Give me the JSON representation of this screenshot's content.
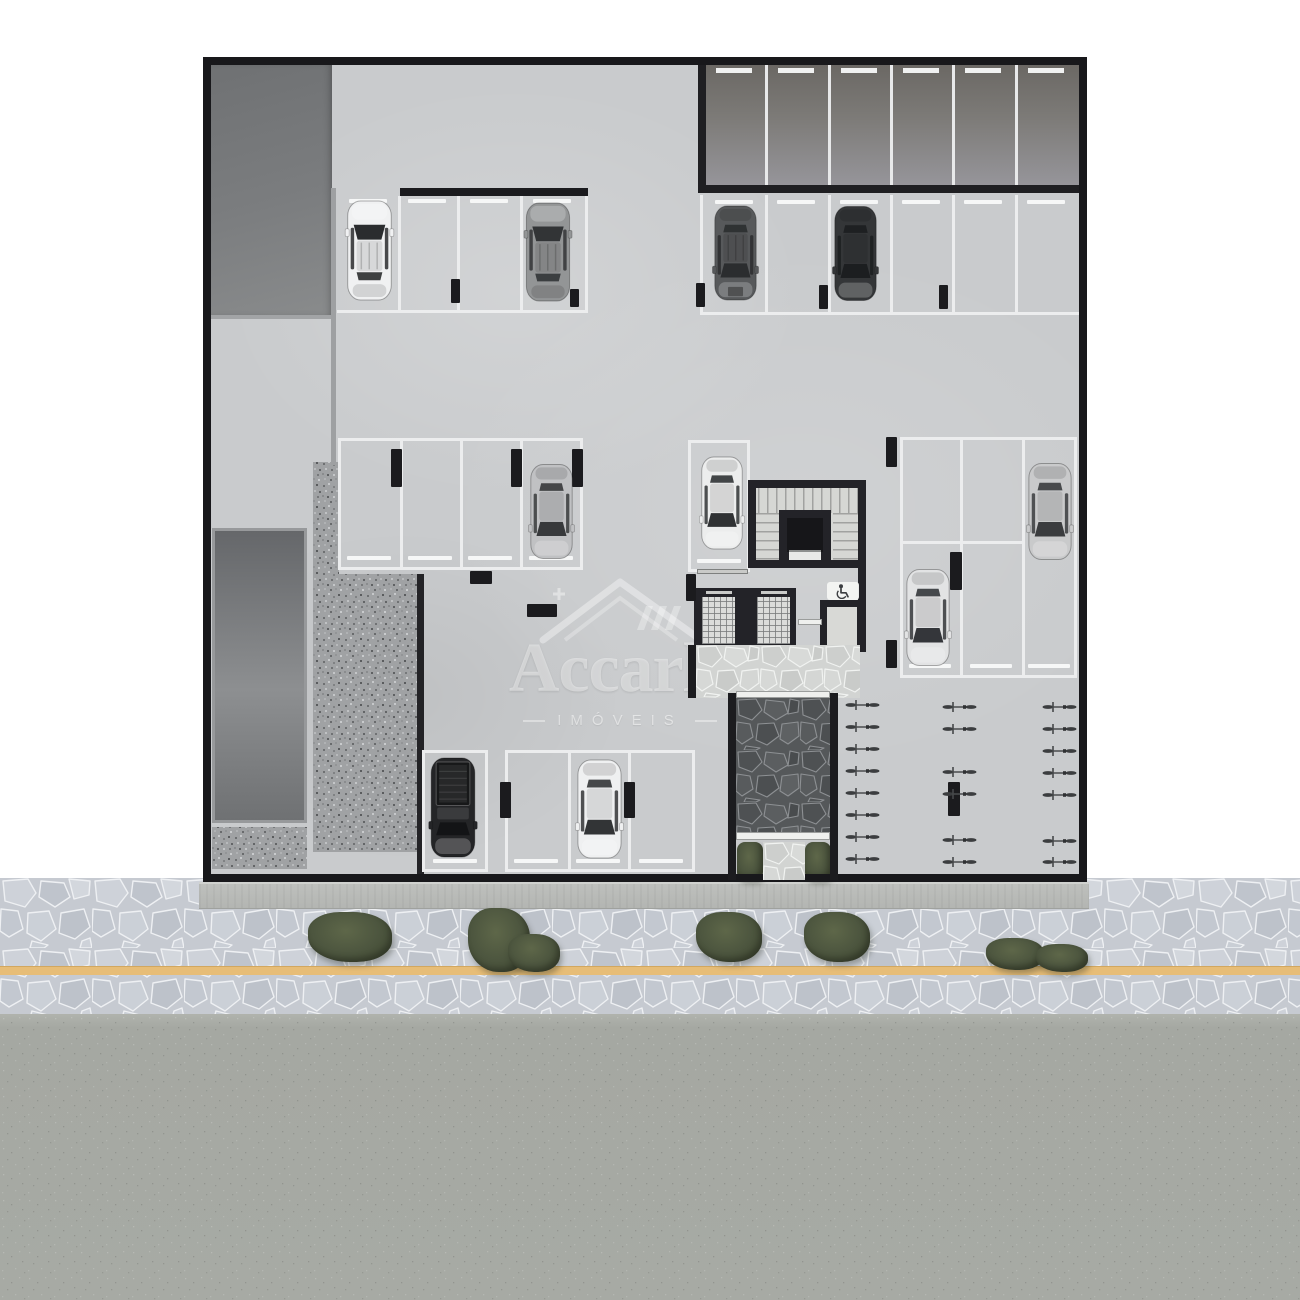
{
  "watermark": {
    "brand": "Accarle",
    "subtitle": "IMÓVEIS",
    "logo": "house-roof-watermark-icon"
  },
  "palette": {
    "plan_floor": "#c9cbcd",
    "plan_border": "#18181b",
    "wall_dark": "#232328",
    "stall_line_white": "#ecedee",
    "gravel": "#a0a2a4",
    "pit_gray": "#7c7e80",
    "hedge_green": "#4d563f",
    "sidewalk_cobble": "#c6cad1",
    "asphalt": "#a7aaa4",
    "lane_line_yellow": "#e7bd77",
    "ramp_floor_dark": "#6b6864"
  },
  "objects": {
    "cars": [
      {
        "id": "car-white-suv-top-left",
        "type": "suv",
        "color": "#f0f1f2",
        "accent": "#2a2c2e",
        "facing": "up",
        "x": 344,
        "y": 199,
        "w": 51,
        "h": 103
      },
      {
        "id": "car-gray-suv-top-left",
        "type": "suv",
        "color": "#939596",
        "accent": "#323436",
        "facing": "up",
        "x": 522,
        "y": 201,
        "w": 52,
        "h": 102
      },
      {
        "id": "car-gray-van-top-right",
        "type": "van",
        "color": "#57595b",
        "accent": "#2b2d2f",
        "facing": "down",
        "x": 712,
        "y": 201,
        "w": 47,
        "h": 104
      },
      {
        "id": "car-black-sedan-top-right",
        "type": "sedan",
        "color": "#343638",
        "accent": "#1c1e20",
        "facing": "down",
        "x": 832,
        "y": 202,
        "w": 47,
        "h": 103
      },
      {
        "id": "car-silver-sedan-middle-left",
        "type": "sedan",
        "color": "#c0c1c3",
        "accent": "#37393b",
        "facing": "down",
        "x": 528,
        "y": 459,
        "w": 47,
        "h": 105
      },
      {
        "id": "car-white-sedan-center",
        "type": "sedan",
        "color": "#eceded",
        "accent": "#303234",
        "facing": "down",
        "x": 699,
        "y": 449,
        "w": 46,
        "h": 108
      },
      {
        "id": "car-silver-sedan-middle-right",
        "type": "sedan",
        "color": "#c9cacb",
        "accent": "#3a3c3e",
        "facing": "down",
        "x": 1026,
        "y": 461,
        "w": 48,
        "h": 101
      },
      {
        "id": "car-white-sedan-middle-right-lower",
        "type": "sedan",
        "color": "#e2e3e4",
        "accent": "#34363a",
        "facing": "down",
        "x": 904,
        "y": 562,
        "w": 48,
        "h": 111
      },
      {
        "id": "car-black-pickup-bottom",
        "type": "pickup",
        "color": "#242527",
        "accent": "#131416",
        "facing": "down",
        "x": 428,
        "y": 756,
        "w": 50,
        "h": 103
      },
      {
        "id": "car-white-sedan-bottom",
        "type": "sedan",
        "color": "#eff0f1",
        "accent": "#323436",
        "facing": "down",
        "x": 575,
        "y": 758,
        "w": 49,
        "h": 102
      }
    ],
    "bike_racks": [
      {
        "id": "bike-rack-column-1",
        "x": 841,
        "ys": [
          699,
          721,
          743,
          765,
          787,
          809,
          831,
          853
        ]
      },
      {
        "id": "bike-rack-column-2",
        "x": 938,
        "ys": [
          701,
          723,
          766,
          788,
          834,
          856
        ]
      },
      {
        "id": "bike-rack-column-3",
        "x": 1038,
        "ys": [
          701,
          723,
          745,
          767,
          789,
          835,
          856
        ]
      }
    ],
    "columns": [
      [
        451,
        279,
        9,
        24
      ],
      [
        570,
        289,
        9,
        18
      ],
      [
        696,
        283,
        9,
        24
      ],
      [
        819,
        285,
        9,
        24
      ],
      [
        939,
        285,
        9,
        24
      ],
      [
        391,
        449,
        11,
        38
      ],
      [
        511,
        449,
        11,
        38
      ],
      [
        572,
        449,
        11,
        38
      ],
      [
        470,
        571,
        22,
        13
      ],
      [
        527,
        604,
        30,
        13
      ],
      [
        886,
        437,
        11,
        30
      ],
      [
        950,
        552,
        12,
        38
      ],
      [
        886,
        640,
        11,
        28
      ],
      [
        500,
        782,
        11,
        36
      ],
      [
        624,
        782,
        11,
        36
      ],
      [
        686,
        574,
        10,
        27
      ],
      [
        948,
        782,
        12,
        34
      ]
    ],
    "bushes": [
      {
        "id": "bush-1",
        "x": 308,
        "y": 912,
        "parts": [
          [
            0,
            0,
            84,
            50
          ]
        ]
      },
      {
        "id": "bush-2",
        "x": 468,
        "y": 908,
        "parts": [
          [
            0,
            0,
            62,
            64
          ],
          [
            40,
            26,
            52,
            38
          ]
        ]
      },
      {
        "id": "bush-3",
        "x": 696,
        "y": 912,
        "parts": [
          [
            0,
            0,
            66,
            50
          ]
        ]
      },
      {
        "id": "bush-4",
        "x": 804,
        "y": 912,
        "parts": [
          [
            0,
            0,
            66,
            50
          ]
        ]
      },
      {
        "id": "bush-5",
        "x": 986,
        "y": 936,
        "parts": [
          [
            0,
            2,
            58,
            32
          ],
          [
            50,
            8,
            52,
            28
          ]
        ]
      }
    ]
  }
}
